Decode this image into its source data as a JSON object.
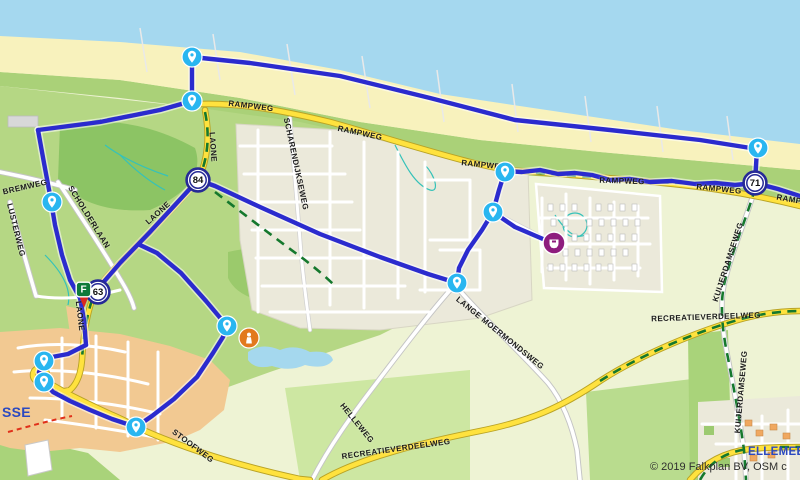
{
  "attribution": "© 2019 Falkplan BV, OSM c",
  "towns": [
    {
      "name": "SSE",
      "x": 2,
      "y": 404,
      "size": 14
    },
    {
      "name": "ELLEMEET",
      "x": 748,
      "y": 446,
      "size": 11.5
    }
  ],
  "road_labels": [
    {
      "text": "RAMPWEG",
      "x": 251,
      "y": 106,
      "rot": 7
    },
    {
      "text": "RAMPWEG",
      "x": 360,
      "y": 133,
      "rot": 12
    },
    {
      "text": "RAMPWEG",
      "x": 484,
      "y": 165,
      "rot": 6
    },
    {
      "text": "RAMPWEG",
      "x": 622,
      "y": 181,
      "rot": 2
    },
    {
      "text": "RAMPWEG",
      "x": 719,
      "y": 189,
      "rot": 6
    },
    {
      "text": "RAMPWEG",
      "x": 799,
      "y": 201,
      "rot": 10
    },
    {
      "text": "LAONE",
      "x": 213,
      "y": 147,
      "rot": 86
    },
    {
      "text": "LAONE",
      "x": 158,
      "y": 213,
      "rot": -42
    },
    {
      "text": "LAONE",
      "x": 80,
      "y": 316,
      "rot": 83
    },
    {
      "text": "BREMWEG",
      "x": 25,
      "y": 187,
      "rot": -13
    },
    {
      "text": "LUSTERWEG",
      "x": 16,
      "y": 230,
      "rot": 76
    },
    {
      "text": "SCHOLDERLAAN",
      "x": 89,
      "y": 217,
      "rot": 58
    },
    {
      "text": "SCHARENDIJKSEWEG",
      "x": 296,
      "y": 164,
      "rot": 78
    },
    {
      "text": "LANGE MOERMONDSWEG",
      "x": 500,
      "y": 333,
      "rot": 39
    },
    {
      "text": "HELLEWEG",
      "x": 357,
      "y": 423,
      "rot": 51
    },
    {
      "text": "STOOFWEG",
      "x": 193,
      "y": 446,
      "rot": 37
    },
    {
      "text": "RECREATIEVERDEELWEG",
      "x": 396,
      "y": 449,
      "rot": -8
    },
    {
      "text": "RECREATIEVERDEELWEG",
      "x": 706,
      "y": 317,
      "rot": -2
    },
    {
      "text": "KUIJERDAMSEWEG",
      "x": 728,
      "y": 262,
      "rot": -72
    },
    {
      "text": "KUIJERDAMSEWEG",
      "x": 741,
      "y": 392,
      "rot": -85
    }
  ],
  "junctions": [
    {
      "number": "84",
      "x": 198,
      "y": 180
    },
    {
      "number": "71",
      "x": 755,
      "y": 183
    },
    {
      "number": "63",
      "x": 98,
      "y": 292
    }
  ],
  "pins": [
    {
      "x": 192,
      "y": 57
    },
    {
      "x": 192,
      "y": 101
    },
    {
      "x": 52,
      "y": 202
    },
    {
      "x": 758,
      "y": 148
    },
    {
      "x": 505,
      "y": 172
    },
    {
      "x": 493,
      "y": 212
    },
    {
      "x": 457,
      "y": 283
    },
    {
      "x": 227,
      "y": 326
    },
    {
      "x": 44,
      "y": 361
    },
    {
      "x": 44,
      "y": 382
    },
    {
      "x": 136,
      "y": 427
    }
  ],
  "pois": [
    {
      "kind": "destination",
      "color": "#8e1d7e",
      "x": 554,
      "y": 243
    },
    {
      "kind": "attraction",
      "color": "#e2791d",
      "x": 249,
      "y": 338
    }
  ],
  "flag": {
    "label": "F",
    "x": 84,
    "y": 290,
    "color": "#0e7a3a",
    "pin_color": "#d92b20"
  },
  "route": {
    "color": "#2b2bce",
    "halo": "#ffffff",
    "segments": [
      [
        [
          192,
          57
        ],
        [
          250,
          63
        ],
        [
          340,
          76
        ],
        [
          430,
          98
        ],
        [
          515,
          120
        ],
        [
          610,
          130
        ],
        [
          700,
          140
        ],
        [
          757,
          149
        ]
      ],
      [
        [
          757,
          149
        ],
        [
          756,
          166
        ],
        [
          755,
          183
        ]
      ],
      [
        [
          755,
          183
        ],
        [
          778,
          189
        ],
        [
          800,
          196
        ]
      ],
      [
        [
          755,
          183
        ],
        [
          735,
          185
        ],
        [
          715,
          183
        ],
        [
          695,
          184
        ],
        [
          672,
          181
        ],
        [
          650,
          182
        ],
        [
          630,
          179
        ],
        [
          610,
          180
        ],
        [
          592,
          175
        ],
        [
          575,
          173
        ],
        [
          558,
          174
        ],
        [
          540,
          170
        ],
        [
          522,
          172
        ],
        [
          505,
          171
        ]
      ],
      [
        [
          505,
          171
        ],
        [
          499,
          190
        ],
        [
          493,
          212
        ]
      ],
      [
        [
          493,
          212
        ],
        [
          515,
          227
        ],
        [
          543,
          239
        ],
        [
          553,
          243
        ]
      ],
      [
        [
          493,
          212
        ],
        [
          482,
          230
        ],
        [
          468,
          250
        ],
        [
          459,
          268
        ],
        [
          457,
          283
        ]
      ],
      [
        [
          457,
          283
        ],
        [
          428,
          274
        ],
        [
          380,
          257
        ],
        [
          320,
          234
        ],
        [
          260,
          207
        ],
        [
          215,
          186
        ],
        [
          198,
          180
        ]
      ],
      [
        [
          198,
          180
        ],
        [
          175,
          205
        ],
        [
          150,
          232
        ],
        [
          120,
          263
        ],
        [
          95,
          292
        ]
      ],
      [
        [
          192,
          57
        ],
        [
          192,
          101
        ]
      ],
      [
        [
          192,
          101
        ],
        [
          160,
          110
        ],
        [
          100,
          122
        ],
        [
          38,
          130
        ]
      ],
      [
        [
          38,
          130
        ],
        [
          44,
          163
        ],
        [
          50,
          195
        ],
        [
          55,
          225
        ],
        [
          62,
          255
        ],
        [
          70,
          280
        ],
        [
          80,
          298
        ],
        [
          84,
          320
        ],
        [
          86,
          345
        ]
      ],
      [
        [
          86,
          345
        ],
        [
          68,
          354
        ],
        [
          52,
          357
        ],
        [
          44,
          361
        ],
        [
          39,
          372
        ],
        [
          44,
          382
        ],
        [
          53,
          392
        ],
        [
          70,
          401
        ],
        [
          90,
          410
        ],
        [
          112,
          419
        ],
        [
          136,
          427
        ]
      ],
      [
        [
          136,
          427
        ],
        [
          152,
          416
        ],
        [
          174,
          399
        ],
        [
          197,
          377
        ],
        [
          213,
          353
        ],
        [
          223,
          337
        ],
        [
          227,
          326
        ]
      ],
      [
        [
          227,
          326
        ],
        [
          206,
          301
        ],
        [
          181,
          273
        ],
        [
          157,
          253
        ],
        [
          140,
          245
        ]
      ]
    ]
  },
  "colors": {
    "water": "#a5d8ef",
    "beach": "#f8f2bd",
    "route_blue": "#2b2bce",
    "pin_blue": "#29b6f0",
    "junction_ring": "#262a96",
    "town_label": "#2b49c0",
    "road_yellow": "#ffe23e",
    "trail_green": "#15782d"
  }
}
